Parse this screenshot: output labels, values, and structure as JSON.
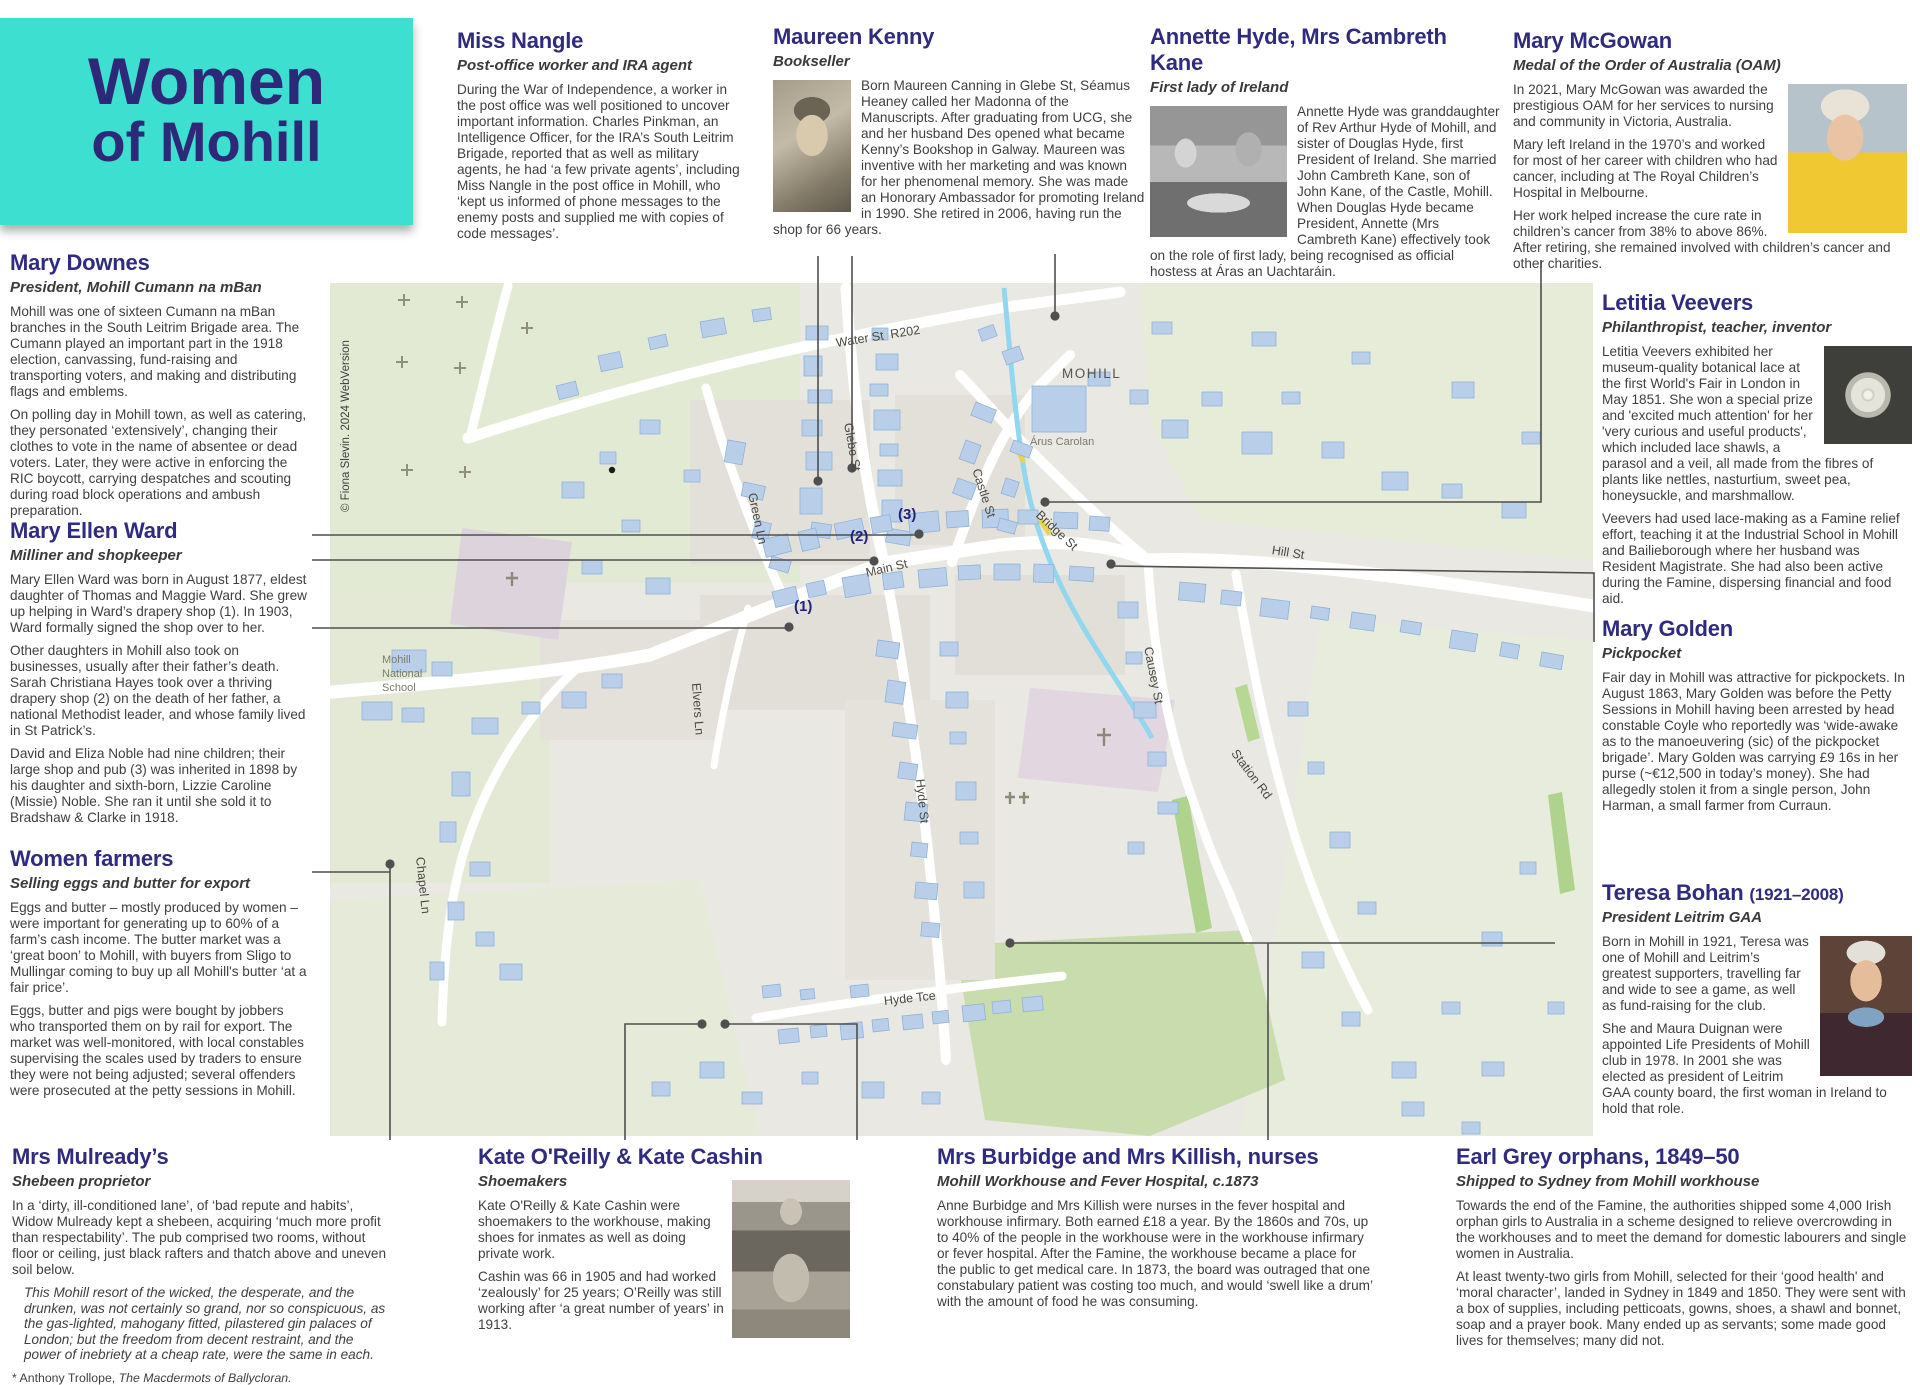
{
  "title": {
    "line1": "Women",
    "line2": "of Mohill"
  },
  "sections": {
    "nangle": {
      "heading": "Miss Nangle",
      "subtitle": "Post-office worker and IRA agent",
      "p1": "During the War of Independence, a worker in the post office was well positioned to uncover important information. Charles Pinkman, an Intelligence Officer, for the IRA’s South Leitrim Brigade, reported that as well as military agents, he had ‘a few private agents’, including Miss Nangle in the post office in Mohill, who ‘kept us informed of phone messages to the enemy posts and supplied me with copies of code messages’."
    },
    "kenny": {
      "heading": "Maureen Kenny",
      "subtitle": "Bookseller",
      "p1": "Born Maureen Canning in Glebe St, Séamus Heaney called her Madonna of the Manuscripts. After graduating from UCG, she and her husband Des opened what became Kenny’s Bookshop in Galway. Maureen was inventive with her marketing and was known for her phenomenal memory. She was made an Honorary Ambassador for promoting Ireland in 1990. She retired in 2006, having run the shop for 66 years."
    },
    "hyde": {
      "heading": "Annette Hyde, Mrs Cambreth Kane",
      "subtitle": "First lady of Ireland",
      "p1": "Annette Hyde was granddaughter of Rev Arthur Hyde of Mohill, and sister of Douglas Hyde, first President of Ireland. She married John Cambreth Kane, son of John Kane, of the Castle, Mohill. When Douglas Hyde became President, Annette (Mrs Cambreth Kane) effectively took on the role of first lady, being recognised as official hostess at Áras an Uachtaráin."
    },
    "mcgowan": {
      "heading": "Mary McGowan",
      "subtitle": "Medal of the Order of Australia (OAM)",
      "p1": "In 2021, Mary McGowan was awarded the prestigious OAM for her services to nursing and community in Victoria, Australia.",
      "p2": "Mary left Ireland in the 1970’s and worked for most of her career with children who had cancer, including at The Royal Children’s Hospital in Melbourne.",
      "p3": "Her work helped increase the cure rate in children’s cancer from 38% to above 86%. After retiring, she remained involved with children’s cancer and other charities."
    },
    "downes": {
      "heading": "Mary Downes",
      "subtitle": "President, Mohill Cumann na mBan",
      "p1": "Mohill was one of sixteen Cumann na mBan branches in the South Leitrim Brigade area. The Cumann played an important part in the 1918 election, canvassing, fund-raising and transporting voters, and making and distributing flags and emblems.",
      "p2": "On polling day in Mohill town, as well as catering, they personated ‘extensively’, changing their clothes to vote in the name of absentee or dead voters. Later, they were active in enforcing the RIC boycott, carrying despatches and scouting during road block operations and ambush preparation."
    },
    "ward": {
      "heading": "Mary Ellen Ward",
      "subtitle": "Milliner and shopkeeper",
      "p1": "Mary Ellen Ward was born in August 1877, eldest daughter of Thomas and Maggie Ward. She grew up helping in Ward’s drapery shop (1). In 1903, Ward formally signed the shop over to her.",
      "p2": "Other daughters in Mohill also took on businesses, usually after their father’s death. Sarah Christiana Hayes took over a thriving drapery shop (2) on the death of her father, a national Methodist leader, and whose family lived in St Patrick’s.",
      "p3": "David and Eliza Noble had nine children; their large shop and pub (3) was inherited in 1898 by his daughter and sixth-born, Lizzie Caroline (Missie) Noble. She ran it until she sold it to Bradshaw & Clarke in 1918."
    },
    "farmers": {
      "heading": "Women farmers",
      "subtitle": "Selling eggs and butter for export",
      "p1": "Eggs and butter – mostly produced by women – were important for generating up to 60% of a farm’s cash income. The butter market was a ‘great boon’ to Mohill, with buyers from Sligo to Mullingar coming to buy up all Mohill's butter ‘at a fair price’.",
      "p2": "Eggs, butter and pigs were bought by jobbers who transported them on by rail for export. The market was well-monitored, with local constables supervising the scales used by traders to ensure they were not being adjusted; several offenders were prosecuted at the petty sessions in Mohill."
    },
    "veevers": {
      "heading": "Letitia Veevers",
      "subtitle": "Philanthropist, teacher, inventor",
      "p1": "Letitia Veevers exhibited her museum-quality botanical lace at the first World's Fair in London in May 1851. She won a special prize and 'excited much attention' for her 'very curious and useful products', which included lace shawls, a parasol and a veil, all made from the fibres of plants like nettles, nasturtium, sweet pea, honeysuckle, and marshmallow.",
      "p2": "Veevers had used lace-making as a Famine relief effort, teaching it at the Industrial School in Mohill and Bailieborough where her husband was Resident Magistrate. She had also been active during the Famine, dispersing financial and food aid."
    },
    "golden": {
      "heading": "Mary Golden",
      "subtitle": "Pickpocket",
      "p1": "Fair day in Mohill was attractive for pickpockets. In August 1863, Mary Golden was before the Petty Sessions in Mohill having been arrested by head constable Coyle who reportedly was ‘wide-awake as to the manoeuvering (sic) of the pickpocket brigade’. Mary Golden was carrying £9 16s in her purse (~€12,500 in today’s money). She had allegedly stolen it from a single person, John Harman, a small farmer from Curraun."
    },
    "bohan": {
      "heading": "Teresa Bohan",
      "heading_suffix": "(1921–2008)",
      "subtitle": "President Leitrim GAA",
      "p1": "Born in Mohill in 1921, Teresa was one of Mohill and Leitrim’s greatest supporters, travelling far and wide to see a game, as well as fund-raising for the club.",
      "p2": "She and Maura Duignan were appointed Life Presidents of Mohill club in 1978. In 2001 she was elected as president of Leitrim GAA county board, the first woman in Ireland to hold that role."
    },
    "mulready": {
      "heading": "Mrs Mulready’s",
      "subtitle": "Shebeen proprietor",
      "p1": "In a ‘dirty, ill-conditioned lane’, of ‘bad repute and habits’, Widow Mulready kept a shebeen, acquiring ‘much more profit than respectability’. The pub comprised two rooms, without floor or ceiling, just black rafters and thatch above and uneven soil below.",
      "quote": "This Mohill resort of the wicked, the desperate, and the drunken, was not certainly so grand, nor so conspicuous, as the gas-lighted, mahogany fitted, pilastered gin palaces of London; but the freedom from decent restraint, and the power of inebriety at a cheap rate, were the same in each.",
      "footnote_prefix": "* Anthony Trollope, ",
      "footnote_title": "The Macdermots of Ballycloran."
    },
    "kate": {
      "heading": "Kate O'Reilly & Kate Cashin",
      "subtitle": "Shoemakers",
      "p1": "Kate O'Reilly & Kate Cashin were shoemakers to the workhouse, making shoes for inmates as well as doing private work.",
      "p2": "Cashin was 66 in 1905 and had worked ‘zealously’ for 25 years; O’Reilly was still working after ‘a great number of years’ in 1913."
    },
    "burbidge": {
      "heading": "Mrs Burbidge and Mrs Killish, nurses",
      "subtitle": "Mohill Workhouse and Fever Hospital, c.1873",
      "p1": "Anne Burbidge and Mrs Killish were nurses in the fever hospital and workhouse infirmary. Both earned £18 a year. By the 1860s and 70s, up to 40% of the people in the workhouse were in the workhouse infirmary or fever hospital. After the Famine, the workhouse became a place for the public to get medical care. In 1873, the board was outraged that one constabulary patient was costing too much, and would ‘swell like a drum’ with the amount of food he was consuming."
    },
    "earlgrey": {
      "heading": "Earl Grey orphans, 1849–50",
      "subtitle": "Shipped to Sydney from Mohill workhouse",
      "p1": "Towards the end of the Famine, the authorities shipped some 4,000 Irish orphan girls to Australia in a scheme designed to relieve overcrowding in the workhouses and to meet the demand for domestic labourers and single women in Australia.",
      "p2": "At least twenty-two girls from Mohill, selected for their ‘good health' and ‘moral character’, landed in Sydney in 1849 and 1850. They were sent with a box of supplies, including petticoats, gowns, shoes, a shawl and bonnet, soap and a prayer book. Many ended up as servants; some made good lives for themselves; many did not."
    }
  },
  "map": {
    "town_label": "MOHILL",
    "venue_label": "Árus Carolan",
    "school_label": "Mohill\nNational\nSchool",
    "copyright": "© Fiona Slevin. 2024 WebVersion",
    "streets": [
      {
        "text": "Water St  R202"
      },
      {
        "text": "Glebe St"
      },
      {
        "text": "Green Ln"
      },
      {
        "text": "Main St"
      },
      {
        "text": "Castle St"
      },
      {
        "text": "Bridge St"
      },
      {
        "text": "Hill St"
      },
      {
        "text": "Causey St"
      },
      {
        "text": "Station Rd"
      },
      {
        "text": "Hyde St"
      },
      {
        "text": "Hyde Tce"
      },
      {
        "text": "Chapel Ln"
      },
      {
        "text": "Elvers Ln"
      }
    ],
    "markers": [
      "(1)",
      "(2)",
      "(3)"
    ]
  },
  "colors": {
    "accent_teal": "#3ddfd0",
    "heading_navy": "#2f2b7e",
    "body_text": "#3f3f3f",
    "map_building": "#b9cfe9",
    "map_road": "#ffffff",
    "river": "#90d7ef"
  }
}
